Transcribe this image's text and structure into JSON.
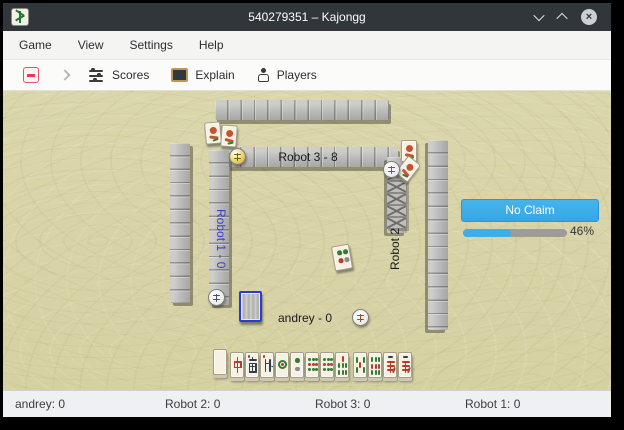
{
  "window": {
    "title": "540279351 – Kajongg",
    "close_glyph": "×"
  },
  "menubar": {
    "items": [
      "Game",
      "View",
      "Settings",
      "Help"
    ]
  },
  "toolbar": {
    "buttons": [
      {
        "id": "scores",
        "label": "Scores"
      },
      {
        "id": "explain",
        "label": "Explain"
      },
      {
        "id": "players",
        "label": "Players"
      }
    ]
  },
  "table": {
    "players": {
      "top": {
        "label": "Robot 3 - 8"
      },
      "left": {
        "label": "Robot 1 - 0"
      },
      "right": {
        "label": "Robot 2"
      },
      "bottom": {
        "label": "andrey - 0"
      }
    },
    "wind_discs": {
      "top": {
        "glyph": "東",
        "color": "#e2c44c"
      },
      "left": {
        "glyph": "西",
        "color": "#ececea"
      },
      "right": {
        "glyph": "北",
        "color": "#ececea"
      },
      "bottom": {
        "glyph": "南",
        "color": "#ececea"
      }
    },
    "claim_panel": {
      "button_label": "No Claim",
      "progress_percent": 46,
      "progress_label": "46%",
      "accent": "#3daee9"
    },
    "hand_tiles": [
      {
        "kind": "blank",
        "glyph": ""
      },
      {
        "kind": "zhong",
        "glyph": "中"
      },
      {
        "kind": "nan",
        "glyph": "南"
      },
      {
        "kind": "bei",
        "glyph": "北"
      },
      {
        "kind": "dot1",
        "glyph": "1 circle"
      },
      {
        "kind": "dot2",
        "glyph": "2 circles"
      },
      {
        "kind": "dot9",
        "glyph": "9 circles"
      },
      {
        "kind": "dot9",
        "glyph": "9 circles"
      },
      {
        "kind": "bamboo7",
        "glyph": "7 bamboo"
      },
      {
        "kind": "bamboo5",
        "glyph": "5 bamboo"
      },
      {
        "kind": "bamboo9",
        "glyph": "9 bamboo"
      },
      {
        "kind": "wan",
        "glyph": "萬"
      },
      {
        "kind": "wan",
        "glyph": "萬"
      }
    ]
  },
  "statusbar": {
    "items": [
      "andrey: 0",
      "Robot 2: 0",
      "Robot 3: 0",
      "Robot 1: 0"
    ]
  }
}
